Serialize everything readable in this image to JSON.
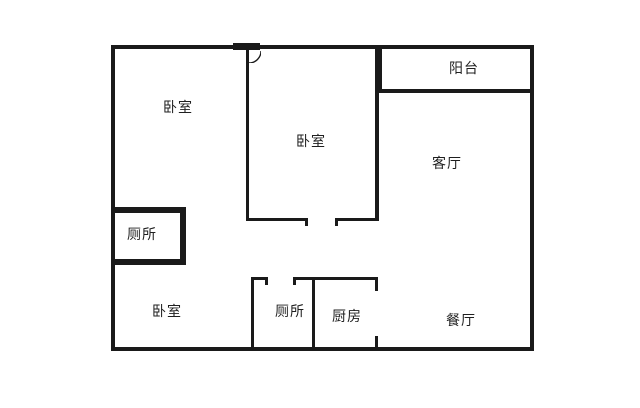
{
  "plan": {
    "type": "apartment-floor-plan",
    "rooms": [
      {
        "id": "bedroom-top-left",
        "label": "卧室"
      },
      {
        "id": "bedroom-middle",
        "label": "卧室"
      },
      {
        "id": "balcony",
        "label": "阳台"
      },
      {
        "id": "living-room",
        "label": "客厅"
      },
      {
        "id": "toilet-upper",
        "label": "厕所"
      },
      {
        "id": "bedroom-bottom",
        "label": "卧室"
      },
      {
        "id": "toilet-lower",
        "label": "厕所"
      },
      {
        "id": "kitchen",
        "label": "厨房"
      },
      {
        "id": "dining-room",
        "label": "餐厅"
      }
    ],
    "colors": {
      "wall": "#1a1a1a",
      "background": "#ffffff",
      "text": "#1f1f1f"
    }
  }
}
